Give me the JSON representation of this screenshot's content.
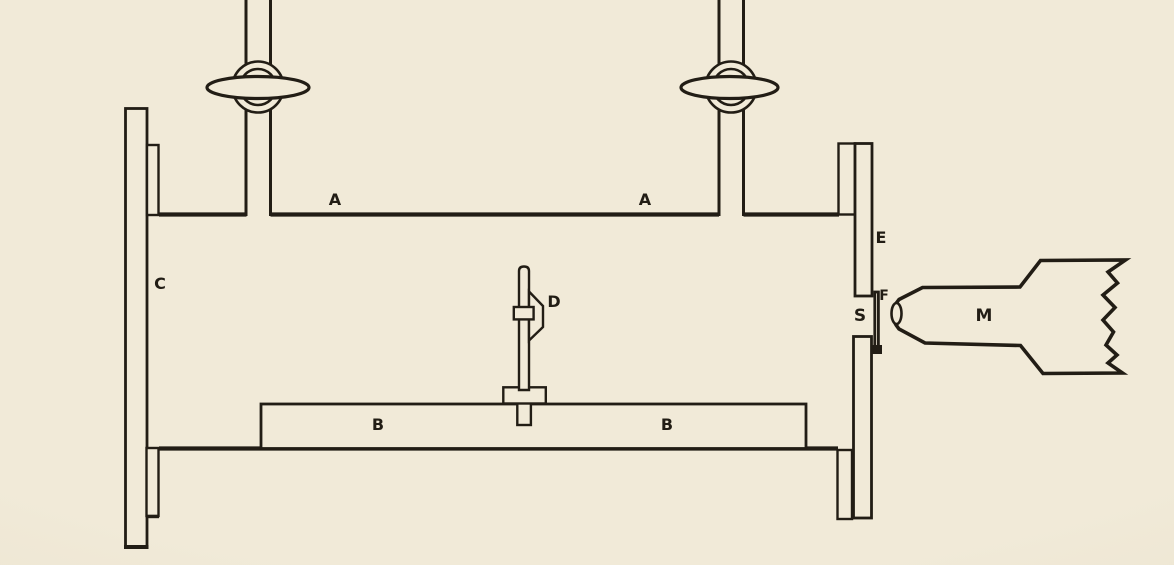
{
  "figure": {
    "description": "Scanned line drawing of a laboratory vacuum-chamber apparatus with two pump tubes, end plates, a slit and a source horn",
    "paper_color": "#f1ead8",
    "ink_color": "#221d15",
    "labels": {
      "a_left": "A",
      "a_right": "A",
      "b_left": "B",
      "b_right": "B",
      "c": "C",
      "d": "D",
      "e": "E",
      "f": "F",
      "s": "S",
      "m": "M"
    }
  }
}
